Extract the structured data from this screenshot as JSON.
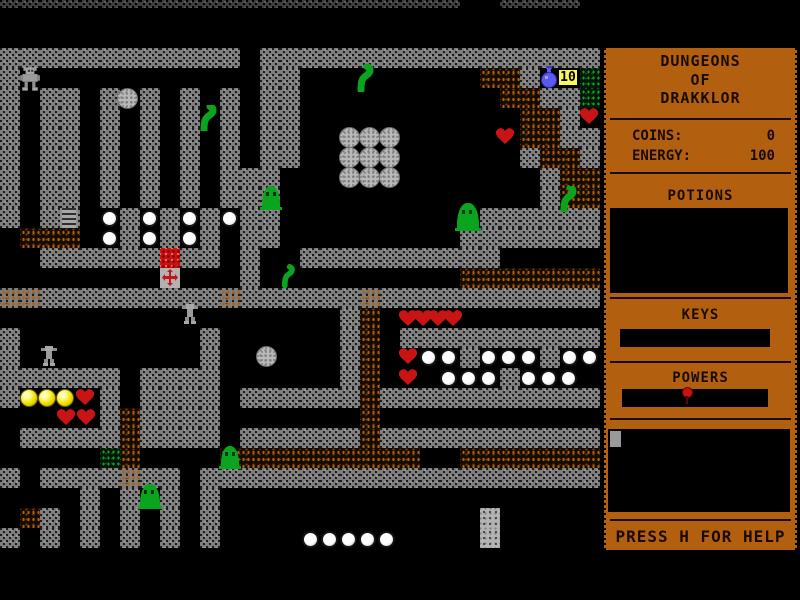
{
  "game": {
    "title_line1": "DUNGEONS",
    "title_line2": "OF",
    "title_line3": "DRAKKLOR",
    "coins_label": "COINS:",
    "coins_value": "0",
    "energy_label": "ENERGY:",
    "energy_value": "100",
    "potions_heading": "POTIONS",
    "keys_heading": "KEYS",
    "powers_heading": "POWERS",
    "help_text": "PRESS H FOR HELP",
    "colors": {
      "panel_orange": "#b2600f",
      "panel_text": "#1a0b00",
      "wall_gray": "#7f7f7f",
      "dirt_orange": "#b35f08",
      "creature_green": "#0aa41e",
      "heart_red": "#c81414",
      "coin_yellow": "#f2e200",
      "potion_blue": "#5a5af0",
      "badge_yellow": "#f8f85a"
    }
  },
  "map": {
    "tile_size": 20,
    "cols": 30,
    "y_offset": -12,
    "legend": {
      "#": "wall",
      ".": "floor",
      "E": "dark-wall",
      "D": "dirt",
      "d": "wall-dirt",
      "G": "moss",
      "R": "rubble"
    },
    "rows": [
      "EEEEEEEEEEEEEEEEEEEEEEE..EEEE.",
      "..............................",
      "..............................",
      "############.#################",
      "#............##.........DD#..G",
      "#.##.#.#.#.#.##..........DD##G",
      "#.##.#.#.#.#.##...........DD#.",
      "#.##.#.#.#.#.##...........DD##",
      "#.##.#.#.#.#.##...........#DD#",
      "#.##.#.#.#.###.............#DD",
      "#.##.#.#.#.###.............#DD",
      "#.##..#.#.#.##..........######",
      ".DDD..#.#.#.##.........#######",
      "..######.##.#..##########.....",
      "............#..........DDDDDDD",
      "dd#########d######d###########",
      ".................#D...........",
      "#.........#......#D.##########",
      "#.........#......#D....#...#..",
      "######.####......#D......#....",
      "#....#.####.######D###########",
      ".....#D####.......D...........",
      ".#####D####.######D###########",
      ".....GD....DDDDDDDDDD..DDDDDDD",
      "#.####d##.####################",
      "....#.#.#.#...................",
      ".D#.#.#.#.#.............R.....",
      "#.#.#.#.#.#.............R.....",
      "..............................",
      "..............................",
      ".............................."
    ],
    "sprites": [
      {
        "t": "player-robot",
        "x": 19,
        "y": 66,
        "w": 22,
        "h": 25
      },
      {
        "t": "gray-ball",
        "x": 117,
        "y": 88
      },
      {
        "t": "worm",
        "x": 197,
        "y": 105,
        "w": 22,
        "h": 26
      },
      {
        "t": "worm",
        "x": 355,
        "y": 64,
        "w": 20,
        "h": 28
      },
      {
        "t": "potion",
        "x": 539,
        "y": 66,
        "w": 20,
        "h": 22
      },
      {
        "t": "count-badge",
        "x": 558,
        "y": 69,
        "label": "10"
      },
      {
        "t": "heart",
        "x": 580,
        "y": 108
      },
      {
        "t": "heart",
        "x": 496,
        "y": 128
      },
      {
        "t": "gray-ball",
        "x": 339,
        "y": 127
      },
      {
        "t": "gray-ball",
        "x": 359,
        "y": 127
      },
      {
        "t": "gray-ball",
        "x": 379,
        "y": 127
      },
      {
        "t": "gray-ball",
        "x": 339,
        "y": 147
      },
      {
        "t": "gray-ball",
        "x": 359,
        "y": 147
      },
      {
        "t": "gray-ball",
        "x": 379,
        "y": 147
      },
      {
        "t": "gray-ball",
        "x": 339,
        "y": 167
      },
      {
        "t": "gray-ball",
        "x": 359,
        "y": 167
      },
      {
        "t": "gray-ball",
        "x": 379,
        "y": 167
      },
      {
        "t": "slime",
        "x": 262,
        "y": 186,
        "w": 18,
        "h": 24
      },
      {
        "t": "worm",
        "x": 557,
        "y": 186,
        "w": 22,
        "h": 26
      },
      {
        "t": "slime",
        "x": 457,
        "y": 203,
        "w": 22,
        "h": 28
      },
      {
        "t": "ladder",
        "x": 60,
        "y": 208
      },
      {
        "t": "white-ball",
        "x": 101,
        "y": 210
      },
      {
        "t": "white-ball",
        "x": 141,
        "y": 210
      },
      {
        "t": "white-ball",
        "x": 181,
        "y": 210
      },
      {
        "t": "white-ball",
        "x": 221,
        "y": 210
      },
      {
        "t": "white-ball",
        "x": 101,
        "y": 230
      },
      {
        "t": "white-ball",
        "x": 141,
        "y": 230
      },
      {
        "t": "white-ball",
        "x": 181,
        "y": 230
      },
      {
        "t": "red-block",
        "x": 160,
        "y": 248
      },
      {
        "t": "cross-block",
        "x": 160,
        "y": 268
      },
      {
        "t": "worm",
        "x": 280,
        "y": 264,
        "w": 16,
        "h": 24
      },
      {
        "t": "robot",
        "x": 180,
        "y": 304,
        "w": 20,
        "h": 20
      },
      {
        "t": "robot",
        "x": 39,
        "y": 346,
        "w": 20,
        "h": 20
      },
      {
        "t": "gray-ball",
        "x": 256,
        "y": 346
      },
      {
        "t": "heart",
        "x": 399,
        "y": 310
      },
      {
        "t": "heart",
        "x": 414,
        "y": 310
      },
      {
        "t": "heart",
        "x": 429,
        "y": 310
      },
      {
        "t": "heart",
        "x": 444,
        "y": 310
      },
      {
        "t": "heart",
        "x": 399,
        "y": 348
      },
      {
        "t": "white-ball",
        "x": 420,
        "y": 349
      },
      {
        "t": "white-ball",
        "x": 440,
        "y": 349
      },
      {
        "t": "white-ball",
        "x": 480,
        "y": 349
      },
      {
        "t": "white-ball",
        "x": 500,
        "y": 349
      },
      {
        "t": "white-ball",
        "x": 520,
        "y": 349
      },
      {
        "t": "white-ball",
        "x": 561,
        "y": 349
      },
      {
        "t": "white-ball",
        "x": 581,
        "y": 349
      },
      {
        "t": "heart",
        "x": 399,
        "y": 369
      },
      {
        "t": "white-ball",
        "x": 440,
        "y": 370
      },
      {
        "t": "white-ball",
        "x": 460,
        "y": 370
      },
      {
        "t": "white-ball",
        "x": 480,
        "y": 370
      },
      {
        "t": "white-ball",
        "x": 520,
        "y": 370
      },
      {
        "t": "white-ball",
        "x": 540,
        "y": 370
      },
      {
        "t": "white-ball",
        "x": 560,
        "y": 370
      },
      {
        "t": "coin",
        "x": 20,
        "y": 389
      },
      {
        "t": "coin",
        "x": 38,
        "y": 389
      },
      {
        "t": "coin",
        "x": 56,
        "y": 389
      },
      {
        "t": "heart",
        "x": 76,
        "y": 389
      },
      {
        "t": "heart",
        "x": 57,
        "y": 409
      },
      {
        "t": "heart",
        "x": 77,
        "y": 409
      },
      {
        "t": "slime",
        "x": 221,
        "y": 446,
        "w": 18,
        "h": 23
      },
      {
        "t": "slime",
        "x": 140,
        "y": 484,
        "w": 20,
        "h": 25
      },
      {
        "t": "white-ball",
        "x": 302,
        "y": 531
      },
      {
        "t": "white-ball",
        "x": 321,
        "y": 531
      },
      {
        "t": "white-ball",
        "x": 340,
        "y": 531
      },
      {
        "t": "white-ball",
        "x": 359,
        "y": 531
      },
      {
        "t": "white-ball",
        "x": 378,
        "y": 531
      }
    ]
  }
}
